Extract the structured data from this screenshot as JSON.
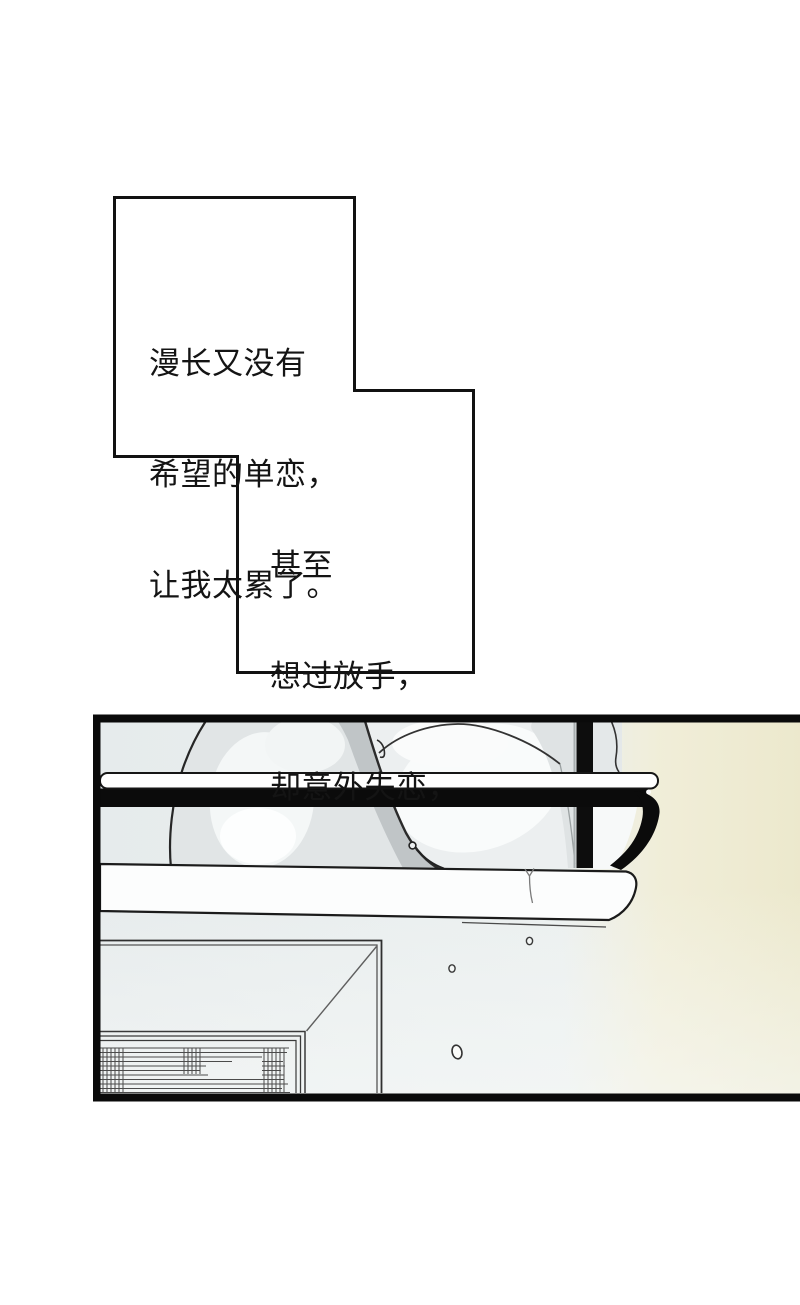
{
  "page": {
    "kind": "comic-page",
    "background": "#ffffff"
  },
  "captions": {
    "box1": {
      "lines": [
        "漫长又没有",
        "希望的单恋，",
        "让我太累了。"
      ]
    },
    "box2": {
      "lines": [
        "甚至",
        "想过放手，",
        "却意外失恋，"
      ]
    }
  },
  "panel": {
    "scene": "plates drying in a wall-mounted dish rack above a shelf, water drops falling past a window frame",
    "droplet_count": 3,
    "colors": {
      "ink": "#0b0b0b",
      "background_cool": "#e8edee",
      "background_warm_glow": "#efecd6",
      "plate_gray": "#e1e5e6",
      "plate_shadow": "#c0c5c7",
      "plate_white": "#f9fbfb",
      "shelf_white": "#fcfdfd"
    }
  }
}
